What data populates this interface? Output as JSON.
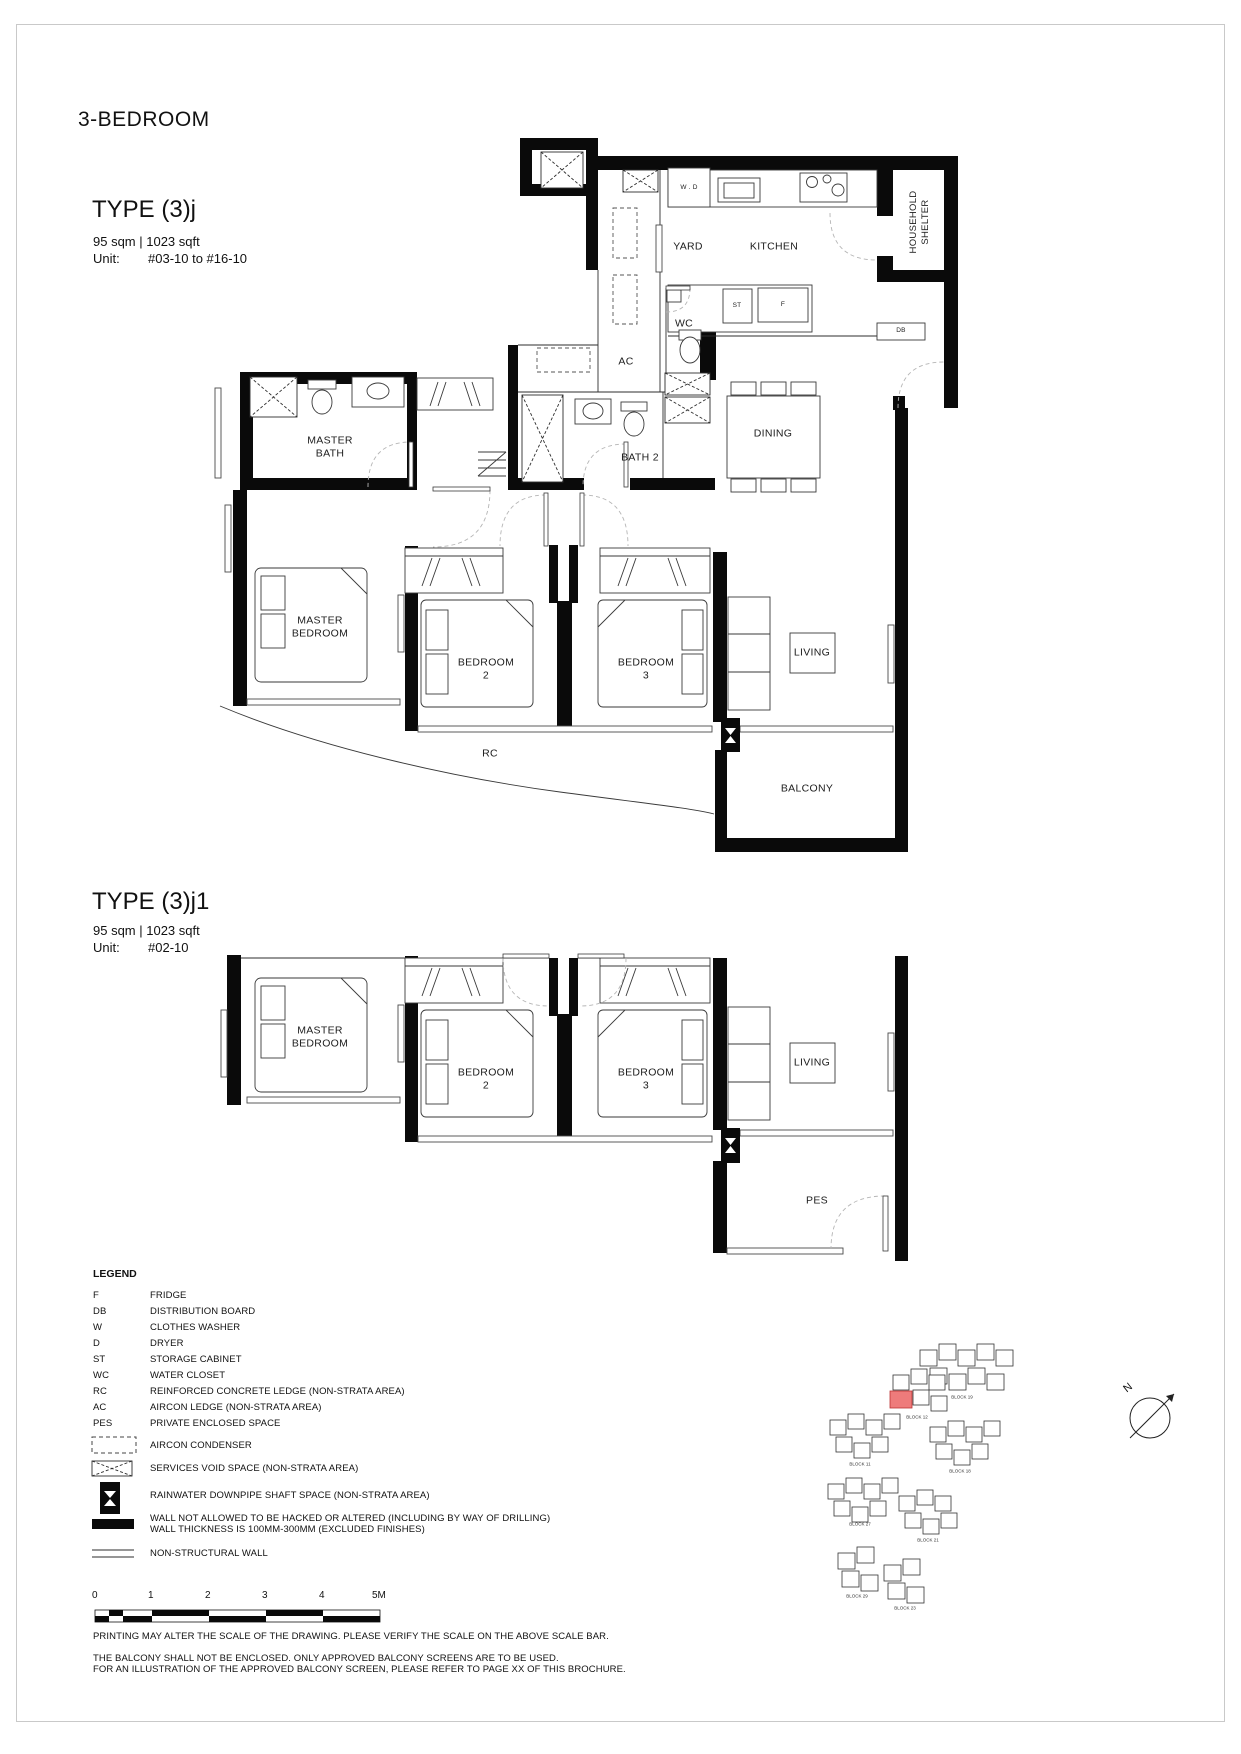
{
  "page": {
    "category": "3-BEDROOM",
    "notes": {
      "scale": "PRINTING MAY ALTER THE SCALE OF THE DRAWING. PLEASE VERIFY THE SCALE ON THE ABOVE SCALE BAR.",
      "balcony1": "THE BALCONY SHALL NOT BE ENCLOSED. ONLY APPROVED BALCONY SCREENS ARE TO BE USED.",
      "balcony2": "FOR AN ILLUSTRATION OF THE APPROVED BALCONY SCREEN, PLEASE REFER TO PAGE XX OF THIS BROCHURE."
    }
  },
  "type1": {
    "name": "TYPE (3)j",
    "area": "95 sqm | 1023 sqft",
    "unit_label": "Unit:",
    "unit_value": "#03-10 to #16-10",
    "labels": {
      "master_bath": "MASTER\nBATH",
      "bath2": "BATH 2",
      "ac": "AC",
      "wc": "WC",
      "yard": "YARD",
      "kitchen": "KITCHEN",
      "wd": "W . D",
      "st": "ST",
      "fridge": "F",
      "db": "DB",
      "household_shelter": "HOUSEHOLD\nSHELTER",
      "dining": "DINING",
      "master_bedroom": "MASTER\nBEDROOM",
      "bedroom2": "BEDROOM\n2",
      "bedroom3": "BEDROOM\n3",
      "living": "LIVING",
      "rc": "RC",
      "balcony": "BALCONY"
    }
  },
  "type2": {
    "name": "TYPE (3)j1",
    "area": "95 sqm | 1023 sqft",
    "unit_label": "Unit:",
    "unit_value": "#02-10",
    "labels": {
      "master_bedroom": "MASTER\nBEDROOM",
      "bedroom2": "BEDROOM\n2",
      "bedroom3": "BEDROOM\n3",
      "living": "LIVING",
      "pes": "PES"
    }
  },
  "legend": {
    "title": "LEGEND",
    "rows": [
      {
        "key": "F",
        "desc": "FRIDGE"
      },
      {
        "key": "DB",
        "desc": "DISTRIBUTION BOARD"
      },
      {
        "key": "W",
        "desc": "CLOTHES WASHER"
      },
      {
        "key": "D",
        "desc": "DRYER"
      },
      {
        "key": "ST",
        "desc": "STORAGE CABINET"
      },
      {
        "key": "WC",
        "desc": "WATER CLOSET"
      },
      {
        "key": "RC",
        "desc": "REINFORCED CONCRETE LEDGE (NON-STRATA AREA)"
      },
      {
        "key": "AC",
        "desc": "AIRCON LEDGE (NON-STRATA AREA)"
      },
      {
        "key": "PES",
        "desc": "PRIVATE ENCLOSED SPACE"
      }
    ],
    "symbols": [
      {
        "icon": "aircon-condenser-icon",
        "desc": "AIRCON CONDENSER"
      },
      {
        "icon": "services-void-icon",
        "desc": "SERVICES VOID SPACE (NON-STRATA AREA)"
      },
      {
        "icon": "rainwater-downpipe-icon",
        "desc": "RAINWATER DOWNPIPE SHAFT SPACE (NON-STRATA AREA)"
      },
      {
        "icon": "structural-wall-icon",
        "desc": "WALL NOT ALLOWED TO BE HACKED OR ALTERED (INCLUDING BY WAY OF DRILLING)\nWALL THICKNESS IS 100MM-300MM (EXCLUDED FINISHES)"
      },
      {
        "icon": "non-structural-wall-icon",
        "desc": "NON-STRUCTURAL WALL"
      }
    ]
  },
  "scalebar": {
    "ticks": [
      "0",
      "1",
      "2",
      "3",
      "4",
      "5M"
    ]
  },
  "siteplan": {
    "north": "N",
    "highlight_color": "#EE7B7B",
    "blocks": [
      "BLOCK 19",
      "BLOCK 12",
      "BLOCK 11",
      "BLOCK 18",
      "BLOCK 27",
      "BLOCK 21",
      "BLOCK 29",
      "BLOCK 23"
    ]
  }
}
